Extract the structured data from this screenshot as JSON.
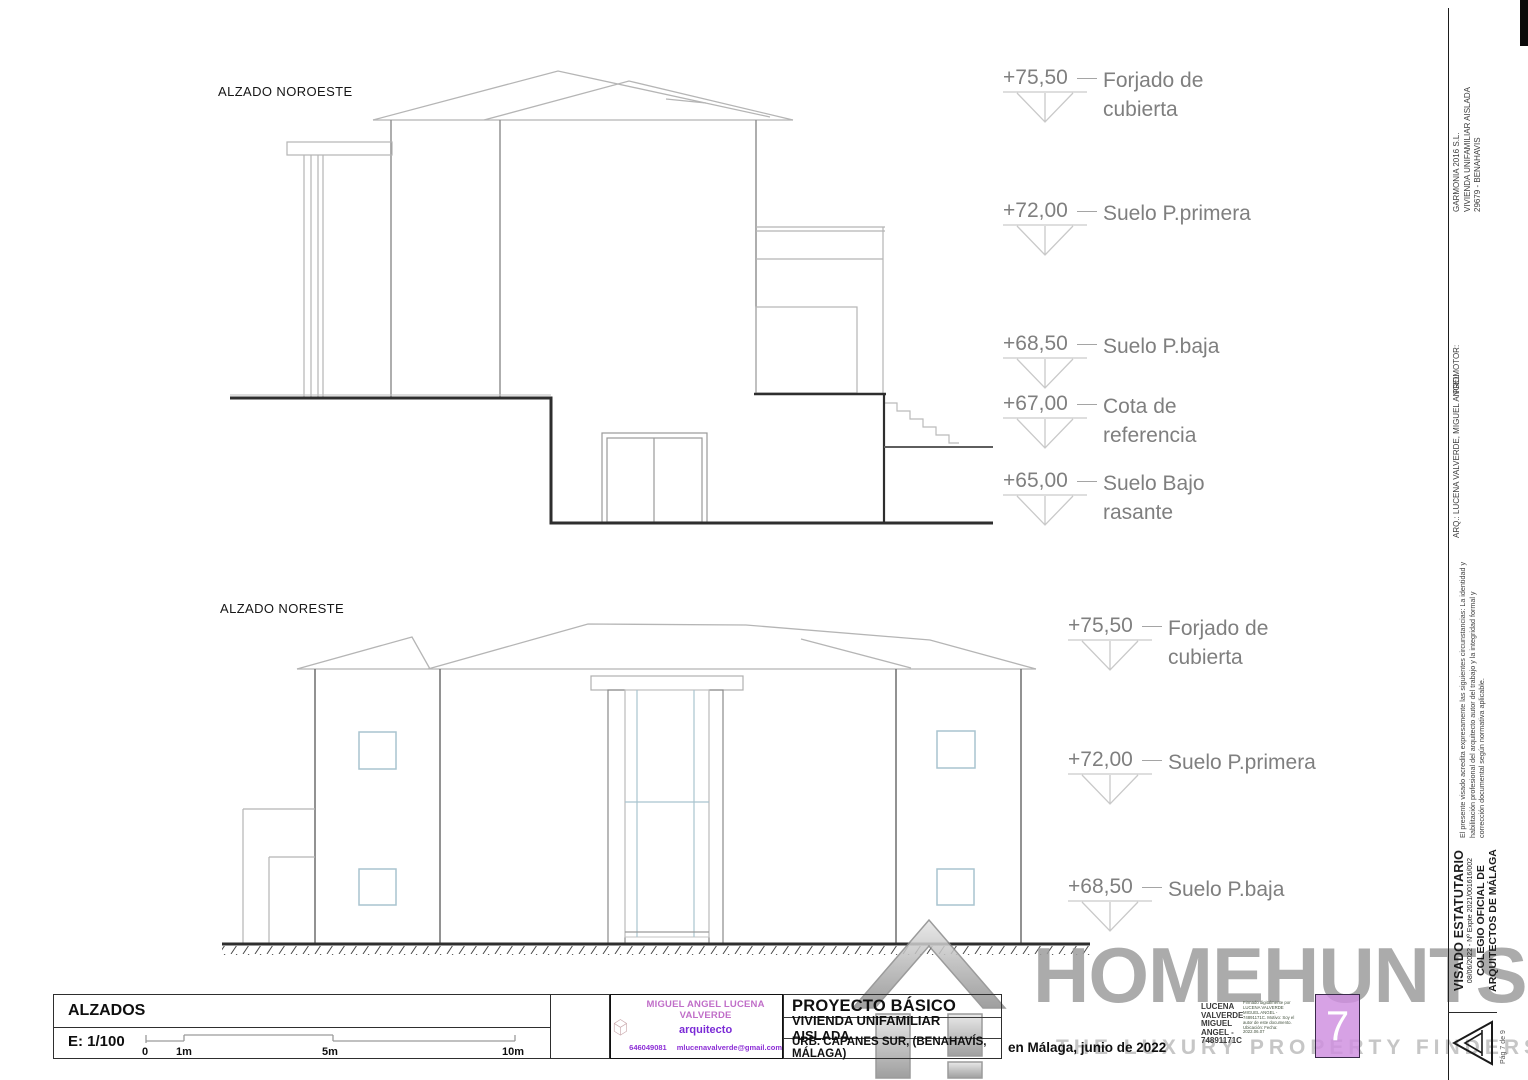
{
  "drawings": {
    "top": {
      "label": "ALZADO NOROESTE",
      "markers": [
        {
          "value": "+75,50",
          "label1": "Forjado de",
          "label2": "cubierta"
        },
        {
          "value": "+72,00",
          "label1": "Suelo P.primera",
          "label2": ""
        },
        {
          "value": "+68,50",
          "label1": "Suelo P.baja",
          "label2": ""
        },
        {
          "value": "+67,00",
          "label1": "Cota de",
          "label2": "referencia"
        },
        {
          "value": "+65,00",
          "label1": "Suelo Bajo",
          "label2": "rasante"
        }
      ]
    },
    "bottom": {
      "label": "ALZADO NORESTE",
      "markers": [
        {
          "value": "+75,50",
          "label1": "Forjado de",
          "label2": "cubierta"
        },
        {
          "value": "+72,00",
          "label1": "Suelo P.primera",
          "label2": ""
        },
        {
          "value": "+68,50",
          "label1": "Suelo P.baja",
          "label2": ""
        }
      ]
    }
  },
  "titleblock": {
    "sheet_title": "ALZADOS",
    "scale_label": "E: 1/100",
    "scale_ticks": [
      "0",
      "1m",
      "5m",
      "10m"
    ],
    "stamp": {
      "name": "MIGUEL ANGEL LUCENA VALVERDE",
      "role": "arquitecto",
      "phone": "646049081",
      "email": "mlucenavalverde@gmail.com"
    },
    "project": {
      "title": "PROYECTO BÁSICO",
      "subtitle": "VIVIENDA UNIFAMILIAR AISLADA",
      "address": "URB. CAPANES SUR, (BENAHAVÍS, MÁLAGA)",
      "date_place": "en Málaga, junio de 2022"
    },
    "signature": {
      "name_block": "LUCENA VALVERDE MIGUEL ANGEL - 74891171C",
      "digital_note": "Firmado digitalmente por LUCENA VALVERDE MIGUEL ANGEL - 74891171C. Motivo: Soy el autor de este documento. Ubicación: Fecha: 2022.06.07"
    },
    "sheet_number": "7"
  },
  "sidebar": {
    "arq_label": "ARQ.: LUCENA VALVERDE, MIGUEL ANGEL",
    "promotor_label": "PROMOTOR:",
    "promotor_name": "GARMONIA 2016 S.L.",
    "promotor_line2": "VIVIENDA UNIFAMILIAR AISLADA",
    "promotor_line3": "29679 - BENAHAVIS",
    "visado_note": "El presente visado acredita expresamente las siguientes circunstancias: La identidad y habilitación profesional del arquitecto autor del trabajo y la integridad formal y corrección documental según normativa aplicable.",
    "visado_title": "VISADO ESTATUTARIO",
    "visado_ref": "08/06/2022 - Nº Expte 2021/001616/002",
    "colegio_line1": "COLEGIO OFICIAL DE",
    "colegio_line2": "ARQUITECTOS DE MÁLAGA",
    "page_label": "Pág 7 de 9"
  },
  "watermark": {
    "brand": "HOMEHUNTS",
    "tagline": "THE LUXURY PROPERTY FINDERS"
  },
  "colors": {
    "sheet_badge": "#cf8fdf",
    "stamp_name": "#c06ec8",
    "stamp_role": "#7b2bd6",
    "stamp_contact": "#8d2fd6",
    "stamp_cube": "#c9a7ab",
    "watermark_gray": "#9d9d9d",
    "window_line": "#a9c4cf",
    "line_light": "#b5b5b5",
    "line_dark": "#2e2e2e"
  }
}
